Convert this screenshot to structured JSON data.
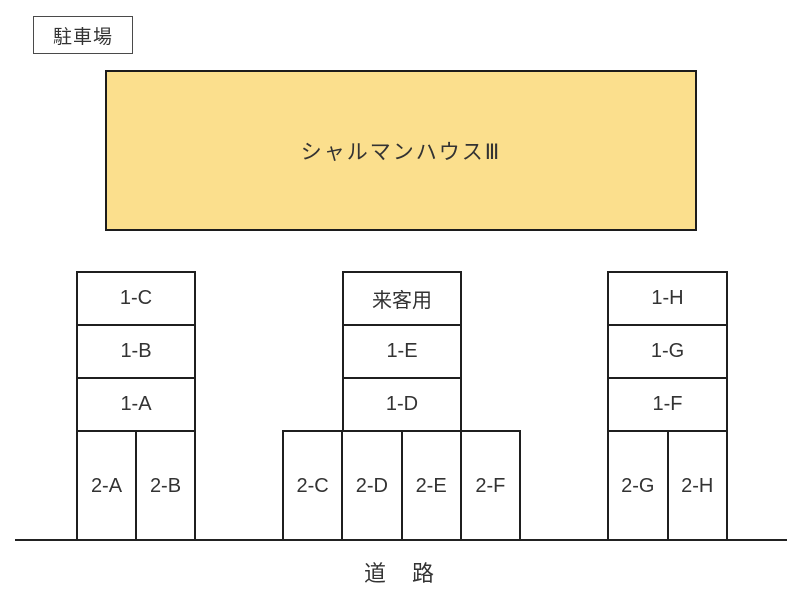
{
  "header": {
    "title": "駐車場"
  },
  "building": {
    "name": "シャルマンハウスⅢ",
    "fill": "#FBDF8D"
  },
  "road": {
    "label": "道　路"
  },
  "groups": [
    {
      "position": "left",
      "rows": [
        "1-C",
        "1-B",
        "1-A"
      ],
      "stalls": [
        "2-A",
        "2-B"
      ]
    },
    {
      "position": "center",
      "rows": [
        "来客用",
        "1-E",
        "1-D"
      ],
      "stalls": [
        "2-C",
        "2-D",
        "2-E",
        "2-F"
      ]
    },
    {
      "position": "right",
      "rows": [
        "1-H",
        "1-G",
        "1-F"
      ],
      "stalls": [
        "2-G",
        "2-H"
      ]
    }
  ],
  "colors": {
    "line": "#1f1f1f",
    "text": "#333333",
    "building_fill": "#FBDF8D"
  }
}
